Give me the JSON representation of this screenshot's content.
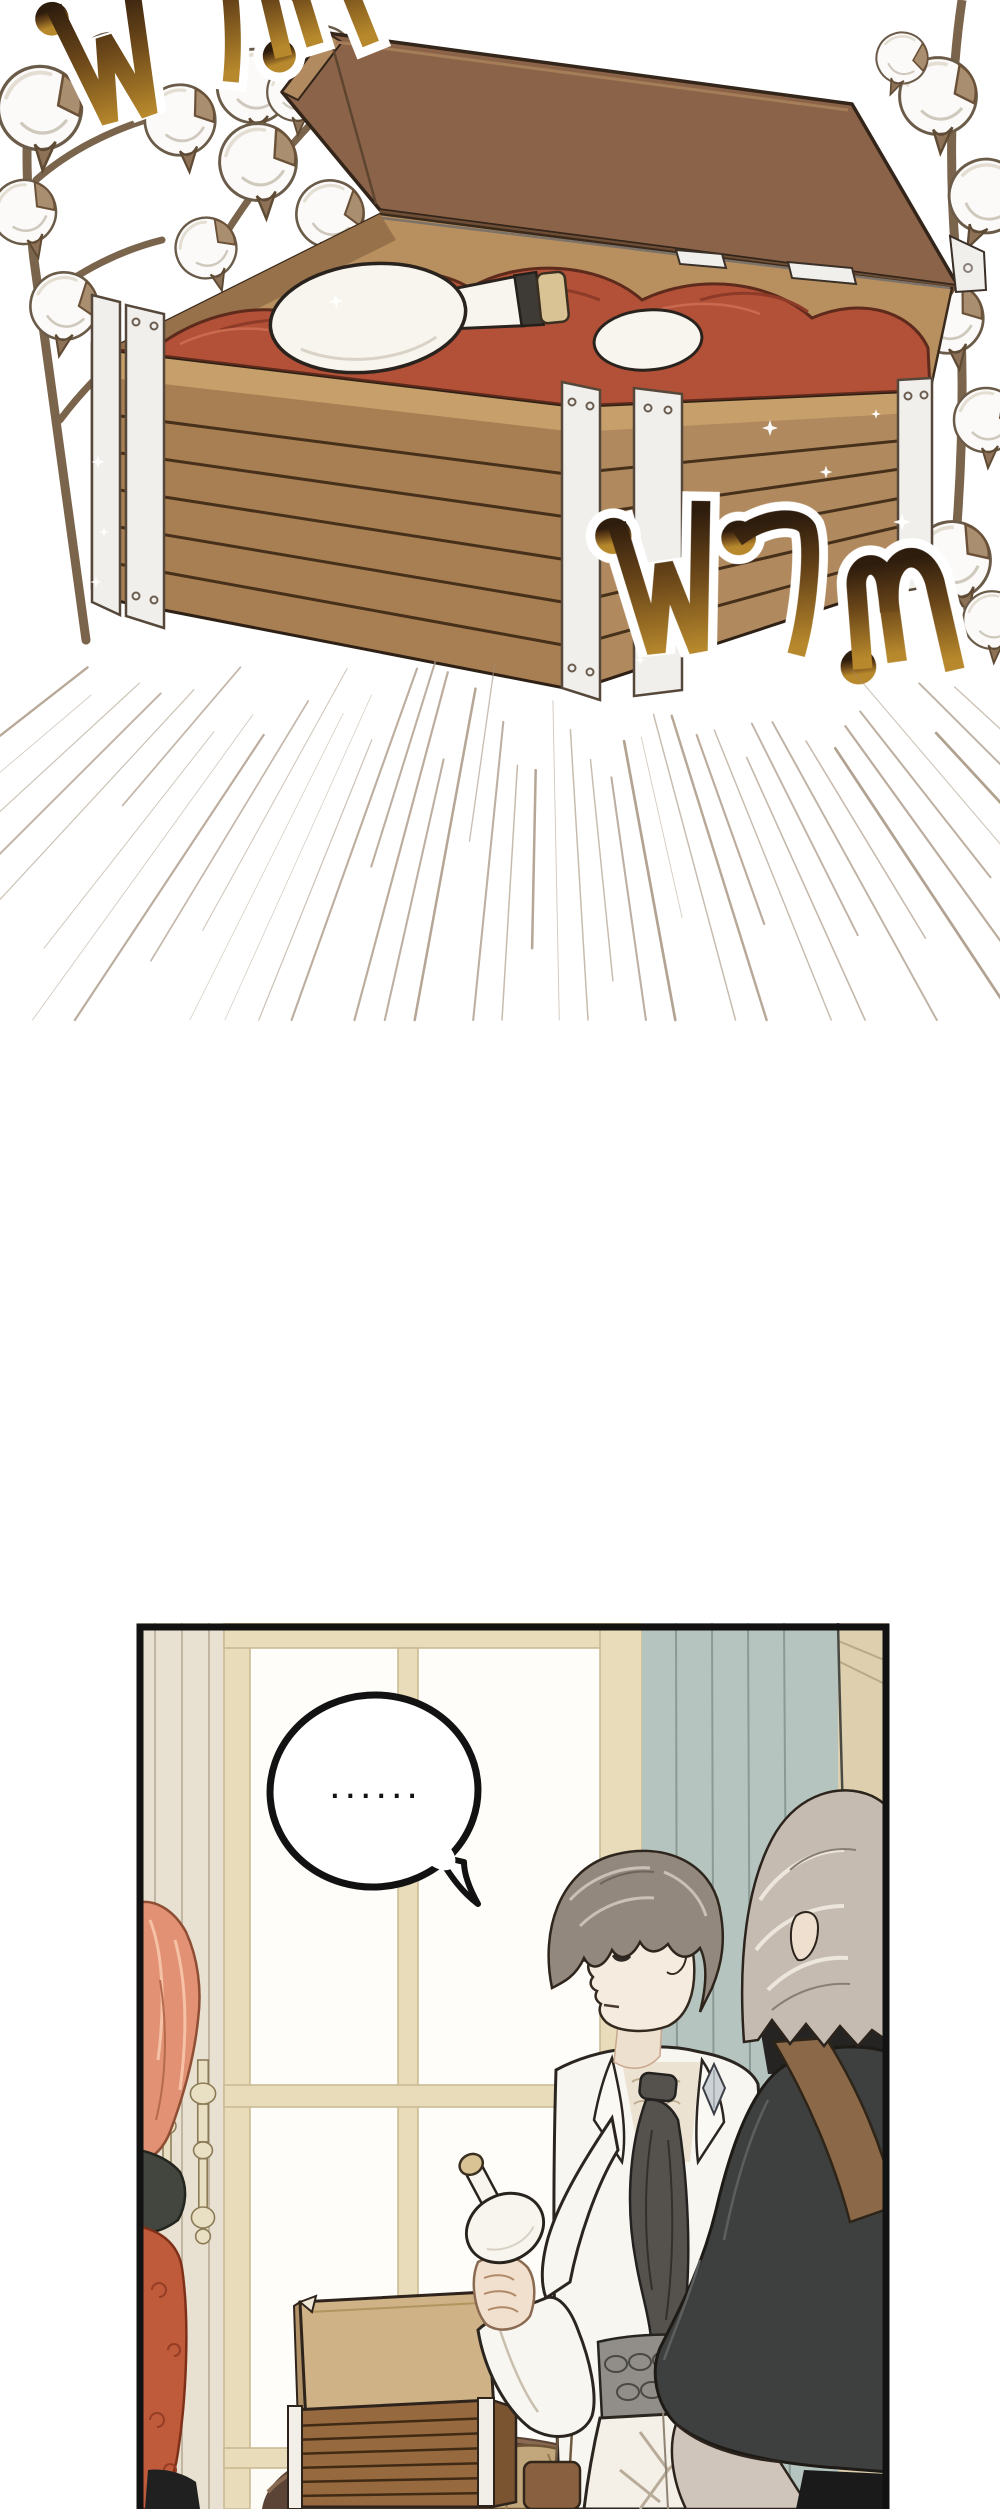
{
  "page": {
    "background": "#ffffff"
  },
  "sfx": {
    "word": "ฟวม",
    "romanized": "fwam (whoosh)",
    "outline_color": "#ffffff",
    "gradient_top": "#2e1c0d",
    "gradient_mid": "#6a4619",
    "gradient_bottom": "#b8892c"
  },
  "speech_bubble": {
    "text": "......",
    "fill": "#ffffff",
    "stroke": "#141414"
  },
  "effects": {
    "speed_lines": {
      "count": 46,
      "color": "#a28e79",
      "center_x": 545,
      "center_y": 310
    }
  },
  "colors": {
    "outline_dark": "#2e2014",
    "crate_wood_front": "#a87e53",
    "crate_wood_right": "#b08a5e",
    "crate_wood_sliver": "#8f6843",
    "crate_rail": "#c69f6a",
    "crate_plank_gap": "#47301a",
    "lid_face": "#8b6348",
    "lid_edge": "#b28a60",
    "lid_edge_dark": "#6f4e36",
    "inner_wall": "#b8905f",
    "inner_wall_shadow": "#96714a",
    "metal_trim": "#f1efec",
    "red_cloth": "#b25138",
    "red_cloth_dark": "#8e3a28",
    "red_cloth_light": "#c96a4e",
    "flask_white": "#f8f5ef",
    "flask_band": "#3e3a36",
    "cork": "#d9c294",
    "cotton_white": "#fbfaf8",
    "bract_brown": "#8d7258",
    "stem_brown": "#7b644c",
    "panel_bg": "#fdfcf7",
    "wall_beige": "#e8e1d1",
    "frame_cream": "#e9dcba",
    "pane_white": "#fefdf9",
    "curtain_sage": "#b5c4be",
    "curtain_fold": "#8a9a94",
    "wall_tan": "#decfae",
    "ornament_cream": "#e9dfc2",
    "hair_red": "#e29175",
    "hair_red_light": "#f6c2a6",
    "dress_orange": "#bf5b3a",
    "dress_swirl": "#953d24",
    "jacket_dark_green": "#43463e",
    "skin": "#f5ebdf",
    "skin_shadow": "#e0cfc2",
    "hair_gray_brown": "#93887e",
    "hair_streak_light": "#c9c1b7",
    "coat_white": "#f8f6f0",
    "lace_shirt": "#ebe2d1",
    "cravat_gray": "#55524e",
    "vest_gray": "#918e89",
    "pants_white": "#f4f0e8",
    "pouch_brown": "#8a6140",
    "fg_hair_gray": "#c5bbb1",
    "fg_hair_streak": "#ece6dd",
    "fg_coat_charcoal": "#3e4040",
    "fg_pants_black": "#1a1a1a",
    "fg_knee_gray": "#cfc5bb",
    "strap_brown": "#8a6848",
    "table_brown": "#5b4436",
    "table_rim": "#8a6a50",
    "sack_tan": "#c2a77c",
    "small_crate_wood": "#96693f",
    "small_crate_lid": "#cfb285",
    "panel_border": "#121212"
  }
}
